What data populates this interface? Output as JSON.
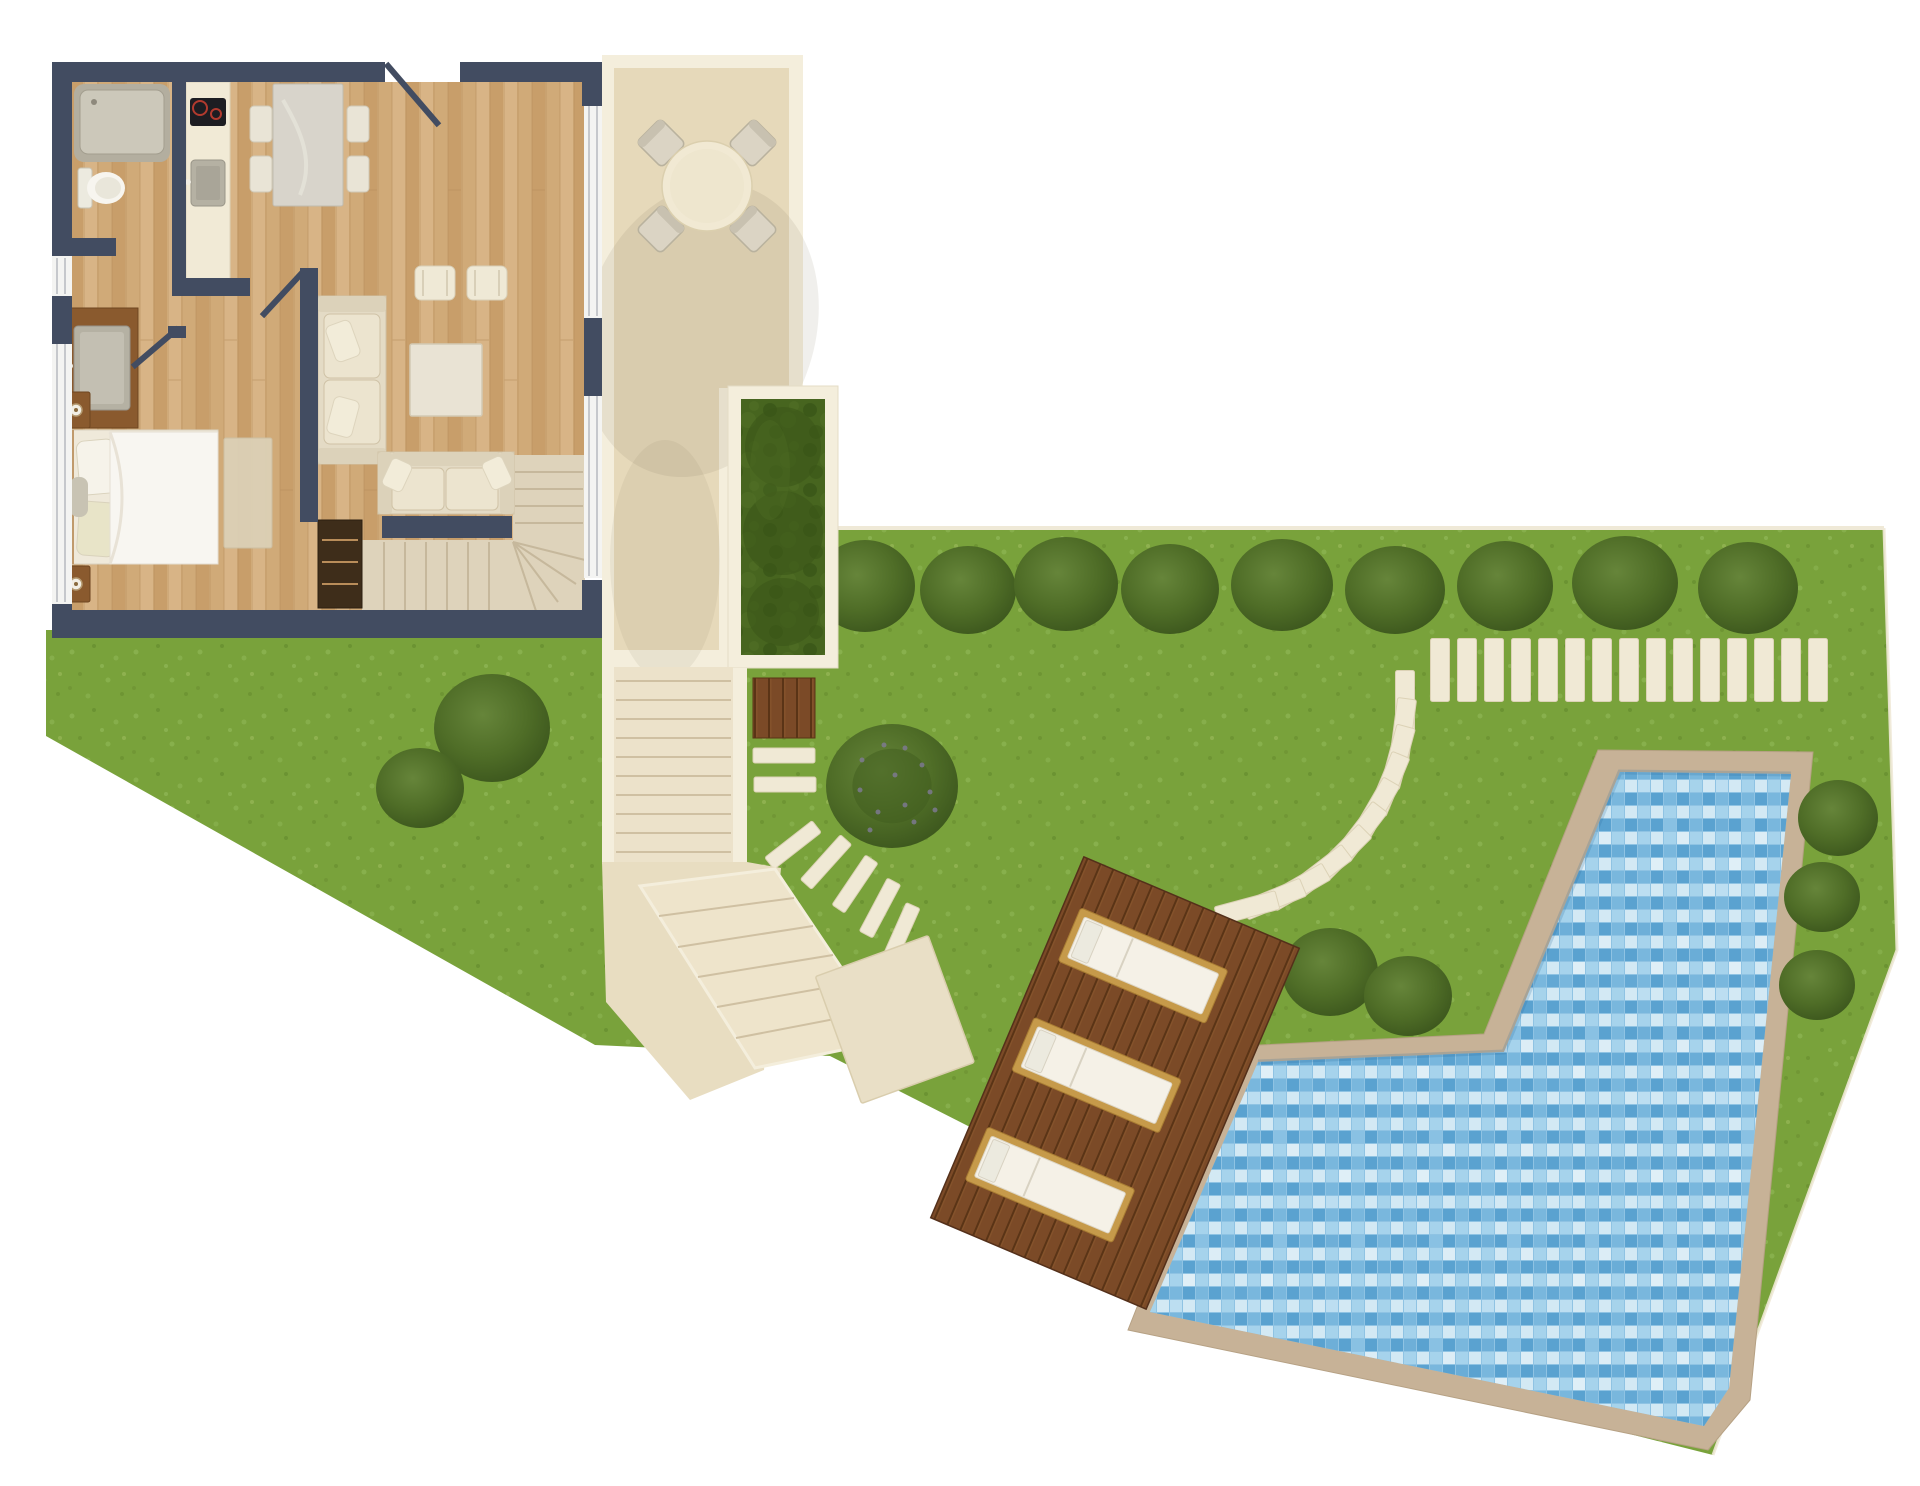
{
  "canvas": {
    "width": 1920,
    "height": 1486,
    "background": "#ffffff"
  },
  "palette": {
    "wall": "#424c61",
    "floorA": "#d0aa78",
    "floorB": "#d8b486",
    "floorC": "#c89e6a",
    "floorLine": "#b68c5a",
    "stairIn": "#ded3bb",
    "stairInLine": "#c6b89c",
    "cream": "#f4eedc",
    "patio": "#e6d9ba",
    "tread": "#ece2ca",
    "treadLine": "#cfc0a2",
    "stone": "#f0e9d5",
    "stoneStroke": "#dcd2b6",
    "plaza": "#e8ddc1",
    "lawn": "#79a23b",
    "lawnLight": "#8cb451",
    "lawnDark": "#63882c",
    "lawnEdge": "#efe9d7",
    "hedge": "#47651f",
    "hedgeDark": "#3a5618",
    "hedgeLight": "#547228",
    "bush": "#55742c",
    "bushDark": "#3f5c1e",
    "flower": "#7f7b96",
    "deck": "#7b4a27",
    "deckLine": "#5a3416",
    "deckLight": "#8d5930",
    "poolBorder": "#c7b297",
    "poolBase": "#8fc3e3",
    "poolT1": "#d3e9f4",
    "poolT2": "#a6d3ec",
    "poolT3": "#79b7dd",
    "poolT4": "#5aa2d0",
    "poolT5": "#e9f4fa",
    "loungerFrame": "#c69a4a",
    "loungerPad": "#f5f1e7",
    "cushion": "#e4dbc5",
    "cushionLight": "#ece4cf",
    "cushionStroke": "#cfc2a6",
    "marble": "#d8d4cb",
    "marbleStroke": "#c0bbaf",
    "whiteSoft": "#f7f5ef",
    "woodFurn": "#8a5a2e",
    "woodFurnDark": "#6e4520",
    "grayShower": "#ccc8ba",
    "grayShowerDark": "#b3ae9f",
    "graySink": "#b5b1a3",
    "glassFill": "#f4f4f2",
    "glassLine": "#b7b9c0",
    "shadow": "#6b5e40"
  },
  "scene": {
    "lawn": {
      "outline": "46,630 733,630 733,528 1884,528 1897,950 1713,1455 1146,1312 970,1127 830,1056 595,1045 46,736",
      "top_edge": [
        733,
        528,
        1884,
        528
      ],
      "right_edge": "1884,528 1897,950 1713,1455"
    },
    "bush_row": [
      [
        865,
        586,
        50,
        46
      ],
      [
        968,
        590,
        48,
        44
      ],
      [
        1066,
        584,
        52,
        47
      ],
      [
        1170,
        589,
        49,
        45
      ],
      [
        1282,
        585,
        51,
        46
      ],
      [
        1395,
        590,
        50,
        44
      ],
      [
        1505,
        586,
        48,
        45
      ],
      [
        1625,
        583,
        53,
        47
      ],
      [
        1748,
        588,
        50,
        46
      ]
    ],
    "garden_bushes": [
      [
        492,
        728,
        58,
        54
      ],
      [
        420,
        788,
        44,
        40
      ],
      [
        1330,
        972,
        48,
        44
      ],
      [
        1408,
        996,
        44,
        40
      ]
    ],
    "flower_bush": {
      "cx": 892,
      "cy": 786,
      "rx": 66,
      "ry": 62,
      "flowers": [
        [
          862,
          760
        ],
        [
          905,
          748
        ],
        [
          930,
          792
        ],
        [
          878,
          812
        ],
        [
          914,
          822
        ],
        [
          860,
          790
        ],
        [
          895,
          775
        ],
        [
          922,
          765
        ],
        [
          884,
          745
        ],
        [
          905,
          805
        ],
        [
          870,
          830
        ],
        [
          935,
          810
        ]
      ]
    },
    "pool_side_bushes": [
      [
        1838,
        818,
        40,
        38
      ],
      [
        1822,
        897,
        38,
        35
      ],
      [
        1817,
        985,
        38,
        35
      ]
    ],
    "stepping_row": [
      [
        1440,
        670,
        0
      ],
      [
        1467,
        670,
        0
      ],
      [
        1494,
        670,
        0
      ],
      [
        1521,
        670,
        0
      ],
      [
        1548,
        670,
        0
      ],
      [
        1575,
        670,
        0
      ],
      [
        1602,
        670,
        0
      ],
      [
        1629,
        670,
        0
      ],
      [
        1656,
        670,
        0
      ],
      [
        1683,
        670,
        0
      ],
      [
        1710,
        670,
        0
      ],
      [
        1737,
        670,
        0
      ],
      [
        1764,
        670,
        0
      ],
      [
        1791,
        670,
        0
      ],
      [
        1818,
        670,
        0
      ]
    ],
    "stepping_fan": [
      [
        1405,
        702,
        0
      ],
      [
        1403,
        730,
        7.5
      ],
      [
        1398,
        757,
        15
      ],
      [
        1389,
        784,
        22.5
      ],
      [
        1376,
        809,
        30
      ],
      [
        1361,
        832,
        37.5
      ],
      [
        1343,
        853,
        45
      ],
      [
        1322,
        871,
        52.5
      ],
      [
        1299,
        887,
        60
      ],
      [
        1274,
        899,
        67.5
      ],
      [
        1247,
        908,
        75
      ]
    ],
    "stone_size": {
      "w": 19,
      "h": 63
    },
    "patio": {
      "wide_outer": [
        602,
        55,
        201,
        345
      ],
      "wide_inner": [
        614,
        68,
        175,
        320
      ],
      "narrow_outer": [
        602,
        390,
        131,
        277
      ],
      "narrow_inner": [
        614,
        388,
        105,
        264
      ],
      "step_band": [
        602,
        650,
        145,
        16
      ],
      "table": {
        "cx": 707,
        "cy": 186,
        "r": 45
      },
      "chairs": [
        [
          661,
          143,
          -45
        ],
        [
          753,
          143,
          45
        ],
        [
          661,
          229,
          45
        ],
        [
          753,
          229,
          -45
        ]
      ]
    },
    "planter": {
      "frame": [
        728,
        386,
        110,
        282
      ],
      "hedge": [
        741,
        399,
        84,
        256
      ],
      "blobs": [
        [
          783,
          447,
          38,
          40
        ],
        [
          783,
          533,
          40,
          42
        ],
        [
          783,
          612,
          36,
          34
        ]
      ]
    },
    "timber_pad": [
      753,
      678,
      62,
      60
    ],
    "path_slats": [
      [
        753,
        748,
        62,
        15
      ],
      [
        754,
        777,
        62,
        15
      ]
    ],
    "path_fan": [
      [
        793,
        845,
        -38
      ],
      [
        826,
        862,
        -48
      ],
      [
        855,
        884,
        -56
      ],
      [
        880,
        908,
        -62
      ],
      [
        901,
        933,
        -66
      ]
    ],
    "small_slat_size": {
      "w": 60,
      "h": 15
    },
    "stairs_upper": {
      "rail_left": [
        602,
        663,
        12,
        201
      ],
      "treads": [
        614,
        667,
        119,
        197
      ],
      "rail_right": [
        733,
        668,
        14,
        196
      ],
      "lines": [
        [
          616,
          681,
          731,
          681
        ],
        [
          616,
          700,
          731,
          700
        ],
        [
          616,
          719,
          731,
          719
        ],
        [
          616,
          738,
          731,
          738
        ],
        [
          616,
          757,
          731,
          757
        ],
        [
          616,
          776,
          731,
          776
        ],
        [
          616,
          795,
          731,
          795
        ],
        [
          616,
          814,
          731,
          814
        ],
        [
          616,
          833,
          731,
          833
        ],
        [
          616,
          852,
          731,
          852
        ]
      ]
    },
    "plaza": "602,862 747,862 781,868 764,1070 690,1100 606,1002",
    "stairs_lower": {
      "poly": "640,886 775,869 890,1040 755,1068",
      "lines": [
        [
          659,
          916,
          794,
          898
        ],
        [
          678,
          947,
          813,
          926
        ],
        [
          698,
          977,
          833,
          955
        ],
        [
          717,
          1007,
          852,
          983
        ],
        [
          736,
          1038,
          871,
          1012
        ]
      ]
    },
    "paver": {
      "rect": [
        835,
        952,
        120,
        135
      ],
      "rot": [
        -20,
        895,
        1020
      ]
    },
    "pool": {
      "border": "1598,750 1813,752 1750,1400 1708,1450 1128,1330 1240,1046 1484,1034",
      "water": "1620,772 1791,774 1729,1388 1704,1426 1150,1312 1258,1062 1504,1052",
      "shade_edge": "1791,774 1620,772 1504,1052 1258,1062"
    },
    "deck": {
      "cx": 1115,
      "cy": 1083,
      "rot": 23,
      "w": 234,
      "h": 392,
      "loungers": [
        -119,
        0,
        119
      ],
      "lounger": {
        "x": -100,
        "w": 160,
        "h": 58,
        "pad_inset": 7,
        "pillow_w": 18
      }
    },
    "house": {
      "floor": [
        72,
        82,
        512,
        528
      ],
      "stair_zone": "M362,540 L513,540 L513,455 L585,455 L585,614 L362,614 Z",
      "stair_lines_lower": [
        [
          384,
          542,
          384,
          612
        ],
        [
          405,
          542,
          405,
          612
        ],
        [
          426,
          542,
          426,
          612
        ],
        [
          447,
          542,
          447,
          612
        ],
        [
          468,
          542,
          468,
          612
        ],
        [
          489,
          542,
          489,
          612
        ]
      ],
      "stair_lines_upper": [
        [
          515,
          472,
          583,
          472
        ],
        [
          515,
          489,
          583,
          489
        ],
        [
          515,
          506,
          583,
          506
        ],
        [
          515,
          523,
          583,
          523
        ]
      ],
      "stair_fan": [
        [
          513,
          542,
          585,
          560
        ],
        [
          513,
          542,
          576,
          584
        ],
        [
          513,
          542,
          558,
          602
        ],
        [
          513,
          542,
          536,
          611
        ]
      ],
      "walls": [
        [
          52,
          62,
          333,
          20
        ],
        [
          460,
          62,
          124,
          20
        ],
        [
          582,
          62,
          20,
          44
        ],
        [
          52,
          62,
          20,
          180
        ],
        [
          52,
          296,
          20,
          48
        ],
        [
          52,
          604,
          20,
          34
        ],
        [
          52,
          610,
          550,
          28
        ],
        [
          172,
          82,
          14,
          198
        ],
        [
          172,
          278,
          78,
          18
        ],
        [
          52,
          238,
          64,
          18
        ],
        [
          300,
          268,
          18,
          254
        ],
        [
          382,
          516,
          130,
          22
        ],
        [
          584,
          318,
          18,
          78
        ],
        [
          582,
          580,
          20,
          34
        ],
        [
          168,
          326,
          18,
          12
        ]
      ],
      "windows": [
        {
          "band": [
            52,
            256,
            20,
            40
          ],
          "lines": [
            [
              57,
              258,
              57,
              294
            ],
            [
              65,
              258,
              65,
              294
            ]
          ]
        },
        {
          "band": [
            52,
            342,
            20,
            262
          ],
          "lines": [
            [
              57,
              344,
              57,
              602
            ],
            [
              65,
              344,
              65,
              602
            ]
          ]
        },
        {
          "band": [
            584,
            102,
            18,
            216
          ],
          "lines": [
            [
              589,
              104,
              589,
              316
            ],
            [
              597,
              104,
              597,
              316
            ]
          ]
        },
        {
          "band": [
            584,
            394,
            18,
            184
          ],
          "lines": [
            [
              589,
              396,
              589,
              576
            ],
            [
              597,
              396,
              597,
              576
            ]
          ]
        }
      ],
      "doors": [
        [
          388,
          66,
          437,
          123
        ],
        [
          301,
          274,
          264,
          314
        ],
        [
          135,
          365,
          176,
          330
        ]
      ],
      "shower": {
        "outer": [
          74,
          84,
          96,
          78
        ],
        "inner": [
          80,
          90,
          84,
          64
        ],
        "drain": [
          94,
          102
        ]
      },
      "toilet": {
        "tank": [
          78,
          168,
          14,
          40
        ],
        "bowl": [
          106,
          188,
          19,
          16
        ],
        "seat": [
          108,
          188,
          13,
          11
        ]
      },
      "vanity": {
        "body": [
          66,
          308,
          72,
          120
        ],
        "sink": [
          74,
          326,
          56,
          84
        ],
        "basin": [
          80,
          332,
          44,
          72
        ]
      },
      "kitchen": {
        "counter": [
          186,
          82,
          44,
          198
        ],
        "cooktop": [
          190,
          98,
          36,
          28
        ],
        "burners": [
          [
            200,
            108,
            7
          ],
          [
            216,
            114,
            5
          ]
        ],
        "sink": [
          191,
          160,
          34,
          46
        ],
        "basin": [
          196,
          166,
          24,
          34
        ]
      },
      "dining": {
        "table": [
          273,
          84,
          70,
          122
        ],
        "chairs": [
          [
            250,
            106
          ],
          [
            250,
            156
          ],
          [
            347,
            106
          ],
          [
            347,
            156
          ]
        ],
        "chair_size": [
          22,
          36
        ]
      },
      "ottomans": [
        [
          415,
          266
        ],
        [
          467,
          266
        ]
      ],
      "sofa": {
        "base": [
          318,
          296,
          68,
          168
        ],
        "arms": [
          [
            318,
            296,
            68,
            16
          ],
          [
            318,
            448,
            68,
            16
          ]
        ],
        "cushions": [
          [
            324,
            314,
            56,
            64
          ],
          [
            324,
            380,
            56,
            64
          ]
        ],
        "pillows": [
          [
            330,
            322,
            26,
            38,
            -20
          ],
          [
            330,
            398,
            26,
            38,
            15
          ]
        ]
      },
      "coffee_table": [
        410,
        344,
        72,
        72
      ],
      "loveseat": {
        "base": [
          378,
          452,
          136,
          62
        ],
        "arms": [
          [
            378,
            452,
            14,
            62
          ],
          [
            500,
            452,
            14,
            62
          ]
        ],
        "back": [
          392,
          452,
          108,
          14
        ],
        "cushions": [
          [
            392,
            468,
            52,
            42
          ],
          [
            446,
            468,
            52,
            42
          ]
        ],
        "pillows": [
          [
            386,
            460,
            22,
            30,
            25
          ],
          [
            486,
            458,
            22,
            30,
            -25
          ]
        ]
      },
      "wardrobe": {
        "body": [
          318,
          520,
          44,
          88
        ],
        "rails": [
          [
            322,
            540,
            358,
            540
          ],
          [
            322,
            562,
            358,
            562
          ],
          [
            322,
            584,
            358,
            584
          ]
        ]
      },
      "bed": {
        "frame": [
          62,
          430,
          156,
          134
        ],
        "headboard": [
          62,
          430,
          12,
          134
        ],
        "pillows": [
          [
            78,
            440,
            38,
            54,
            -5
          ],
          [
            78,
            502,
            38,
            54,
            4
          ]
        ],
        "roll": [
          70,
          477,
          18,
          40
        ],
        "duvet": [
          110,
          432,
          108,
          132
        ],
        "fold": "M110,432 C126,475 126,520 110,564"
      },
      "nightstands": [
        [
          62,
          392,
          28,
          36
        ],
        [
          62,
          566,
          28,
          36
        ]
      ],
      "lamps": [
        [
          76,
          410
        ],
        [
          76,
          584
        ]
      ],
      "rug": [
        224,
        438,
        48,
        110
      ]
    }
  }
}
